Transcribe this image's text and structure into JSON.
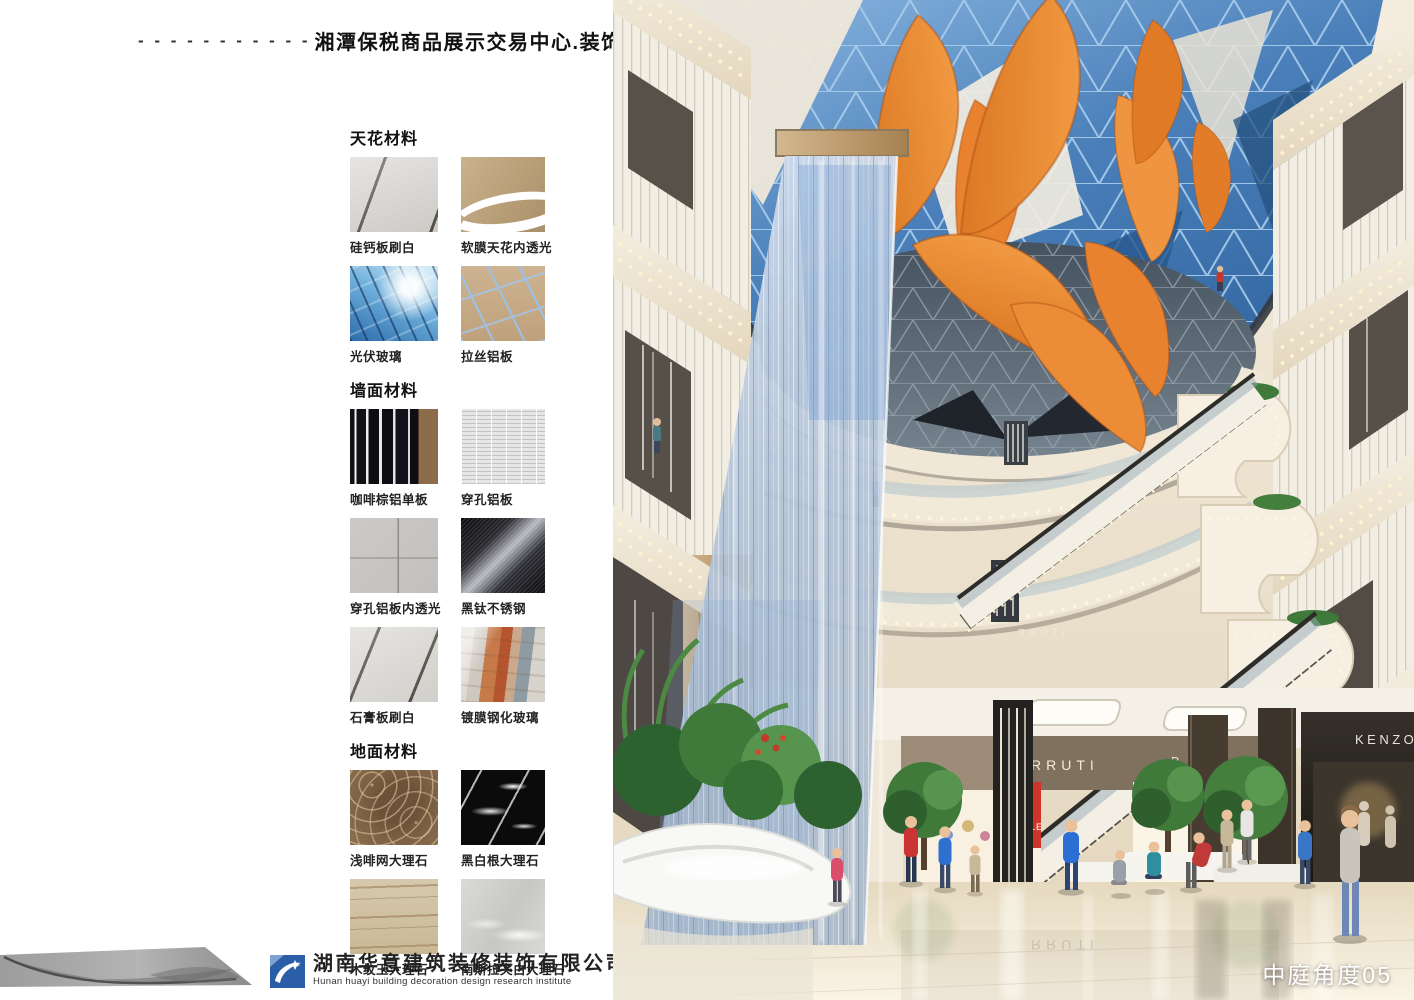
{
  "page": {
    "title_dashes": "- - - - - - - - - - -",
    "title": "湘潭保税商品展示交易中心.装饰设计"
  },
  "materials": {
    "sections": [
      {
        "header": "天花材料",
        "items": [
          {
            "label": "硅钙板刷白",
            "texture": "tex-silicate"
          },
          {
            "label": "软膜天花内透光",
            "texture": "tex-softfilm"
          },
          {
            "label": "光伏玻璃",
            "texture": "tex-pv-glass"
          },
          {
            "label": "拉丝铝板",
            "texture": "tex-brushed-alu"
          }
        ]
      },
      {
        "header": "墙面材料",
        "items": [
          {
            "label": "咖啡棕铝单板",
            "texture": "tex-coffee-alu"
          },
          {
            "label": "穿孔铝板",
            "texture": "tex-perf-alu"
          },
          {
            "label": "穿孔铝板内透光",
            "texture": "tex-perf-light"
          },
          {
            "label": "黑钛不锈钢",
            "texture": "tex-black-ti"
          },
          {
            "label": "石膏板刷白",
            "texture": "tex-gypsum"
          },
          {
            "label": "镀膜钢化玻璃",
            "texture": "tex-coated-glass"
          }
        ]
      },
      {
        "header": "地面材料",
        "items": [
          {
            "label": "浅啡网大理石",
            "texture": "tex-coffee-marble"
          },
          {
            "label": "黑白根大理石",
            "texture": "tex-bw-marble"
          },
          {
            "label": "木纹玉大理石",
            "texture": "tex-wood-marble"
          },
          {
            "label": "南斯拉夫白大理石",
            "texture": "tex-white-marble"
          }
        ]
      }
    ]
  },
  "footer": {
    "company_cn": "湖南华意建筑装修装饰有限公司",
    "company_en": "Hunan huayi building decoration design research institute"
  },
  "rendering": {
    "view_label": "中庭角度05",
    "signs": {
      "store_left": "RRUTI",
      "store_mid": "BTA",
      "store_right": "KENZO",
      "sale_tag": "SALE",
      "upper_store": "RRUTI"
    },
    "colors": {
      "skylight_blue": "#3f6fa8",
      "leaf_orange": "#e8832f",
      "wall_cream": "#ece2cf",
      "fascia_brown": "#80705e",
      "logo_blue": "#2b5ea8",
      "floor_beige": "#efe6d2",
      "waterfall_blue": "#a9bdd2"
    }
  }
}
